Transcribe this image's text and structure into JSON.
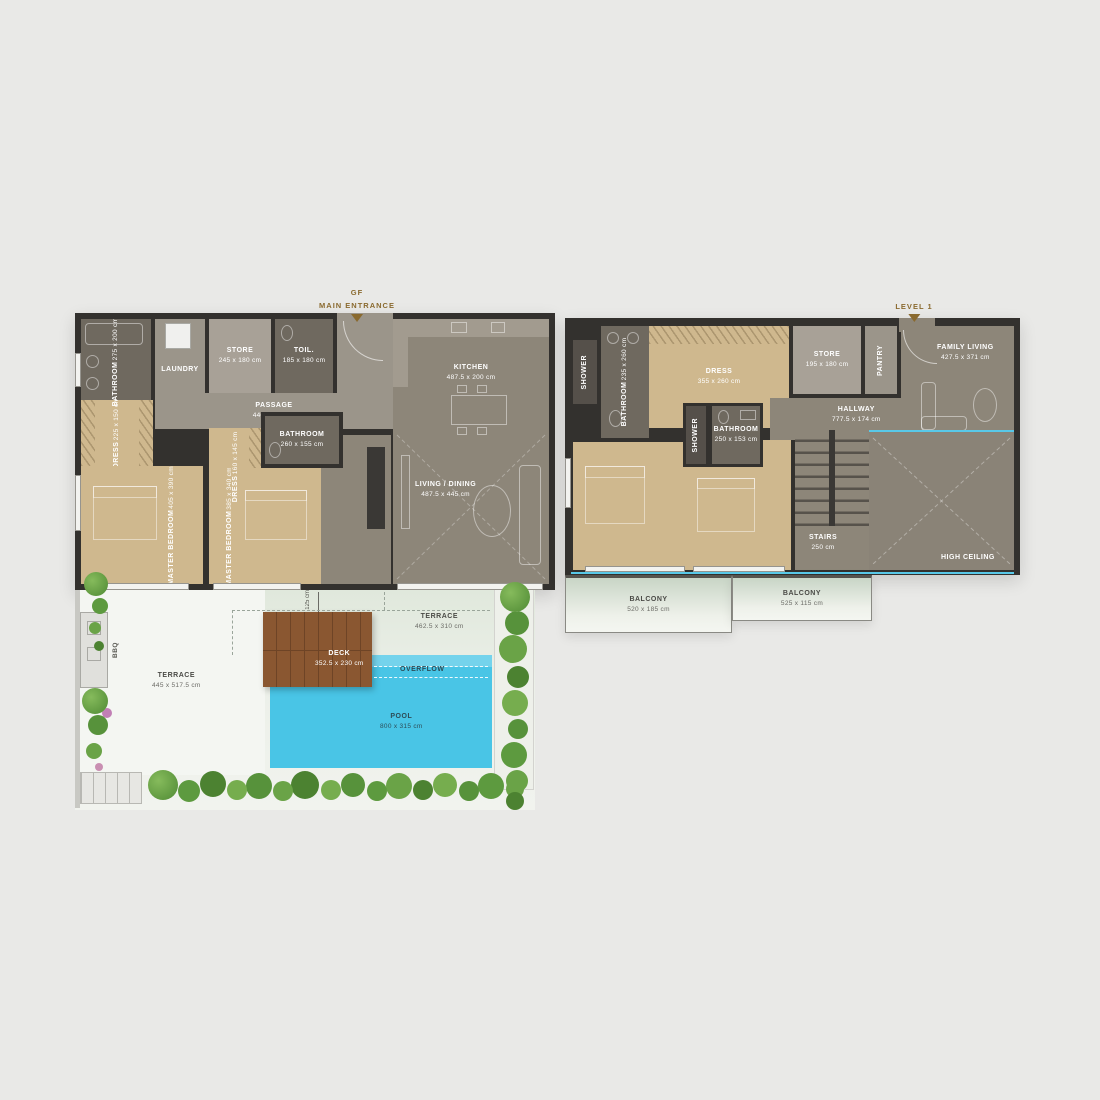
{
  "colors": {
    "bg": "#e9e9e7",
    "wall": "#33312e",
    "floor-gray": "#8d8679",
    "floor-light": "#9b958a",
    "floor-store": "#a8a197",
    "bath": "#6f695f",
    "shower": "#55504a",
    "tan": "#cfb88e",
    "pool": "#49c5e6",
    "pool-light": "#74d3ec",
    "deck": "#8a5731",
    "deck-line": "#6e4426",
    "accent": "#8a6a2f",
    "cyan-line": "#58c8e8",
    "terrace": "#f4f6f2",
    "garden": "#e3eadf",
    "label-dark": "#4a4a46"
  },
  "gf": {
    "header": {
      "line1": "GF",
      "line2": "MAIN ENTRANCE"
    },
    "rooms": {
      "bathroom1": {
        "name": "BATHROOM",
        "dims": "275 x 200 cm"
      },
      "laundry": {
        "name": "LAUNDRY"
      },
      "store": {
        "name": "STORE",
        "dims": "245 x 180 cm"
      },
      "toilet": {
        "name": "TOIL.",
        "dims": "185 x 180 cm"
      },
      "kitchen": {
        "name": "KITCHEN",
        "dims": "487.5 x 200 cm"
      },
      "passage": {
        "name": "PASSAGE",
        "dims": "440 x 120 cm"
      },
      "dress1": {
        "name": "DRESS",
        "dims": "225 x 150 cm"
      },
      "master1": {
        "name": "MASTER BEDROOM",
        "dims": "405 x 390 cm"
      },
      "dress2": {
        "name": "DRESS",
        "dims": "160 x 145 cm"
      },
      "master2": {
        "name": "MASTER BEDROOM",
        "dims": "385 x 340 cm"
      },
      "bathroom2": {
        "name": "BATHROOM",
        "dims": "260 x 155 cm"
      },
      "living": {
        "name": "LIVING / DINING",
        "dims": "487.5 x 445 cm"
      }
    }
  },
  "outdoor": {
    "terrace1": {
      "name": "TERRACE",
      "dims": "445 x 517.5 cm"
    },
    "terrace2": {
      "name": "TERRACE",
      "dims": "462.5 x 310 cm"
    },
    "deck": {
      "name": "DECK",
      "dims": "352.5 x 230 cm"
    },
    "overflow": {
      "name": "OVERFLOW"
    },
    "pool": {
      "name": "POOL",
      "dims": "800 x 315 cm"
    },
    "bbq": {
      "name": "BBQ"
    },
    "deck_offset": "125 cm"
  },
  "level1": {
    "header": {
      "line1": "LEVEL 1"
    },
    "rooms": {
      "shower1": {
        "name": "SHOWER"
      },
      "bathroom1": {
        "name": "BATHROOM",
        "dims": "235 x 260 cm"
      },
      "dress": {
        "name": "DRESS",
        "dims": "355 x 260 cm"
      },
      "store": {
        "name": "STORE",
        "dims": "195 x 180 cm"
      },
      "pantry": {
        "name": "PANTRY"
      },
      "family": {
        "name": "FAMILY LIVING",
        "dims": "427.5 x 371 cm"
      },
      "hallway": {
        "name": "HALLWAY",
        "dims": "777.5 x 174 cm"
      },
      "shower2": {
        "name": "SHOWER"
      },
      "bathroom2": {
        "name": "BATHROOM",
        "dims": "250 x 153 cm"
      },
      "master1": {
        "name": "MASTER BEDROOM",
        "dims": "355 x 515 cm"
      },
      "master2": {
        "name": "MASTER BEDROOM",
        "dims": "370 x 330 cm"
      },
      "stairs": {
        "name": "STAIRS",
        "dims": "250 cm"
      },
      "high_ceiling": {
        "name": "HIGH CEILING"
      },
      "balcony1": {
        "name": "BALCONY",
        "dims": "520 x 185 cm"
      },
      "balcony2": {
        "name": "BALCONY",
        "dims": "525 x 115 cm"
      }
    }
  }
}
